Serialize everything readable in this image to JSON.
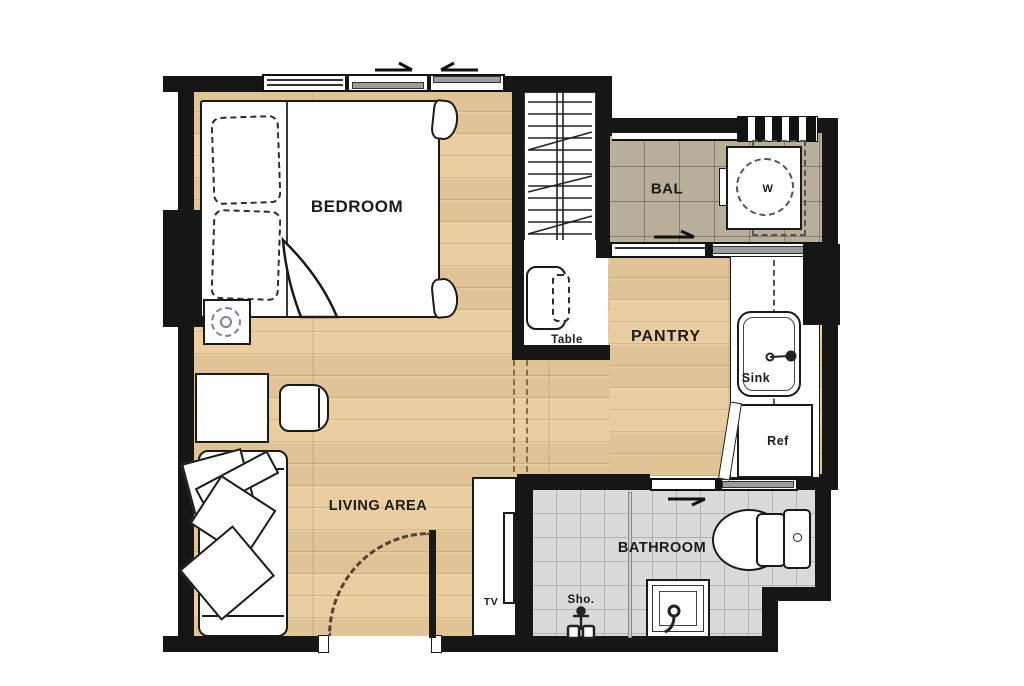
{
  "plan": {
    "type": "apartment-floor-plan",
    "labels": {
      "bedroom": "BEDROOM",
      "balcony": "BAL",
      "washer": "W",
      "desk": "Table",
      "pantry": "PANTRY",
      "sink": "Sink",
      "fridge": "Ref",
      "living": "LIVING AREA",
      "tv": "TV",
      "bathroom": "BATHROOM",
      "shower": "Sho."
    },
    "colors": {
      "wall": "#161616",
      "wood_floor": "#e9cb9b",
      "balcony_tile": "#b8af9a",
      "bathroom_tile": "#dadada",
      "window_sash": "#9c9c9c",
      "lamp_accent": "#7d7da8",
      "door_swing_arc": "#54432e"
    }
  }
}
